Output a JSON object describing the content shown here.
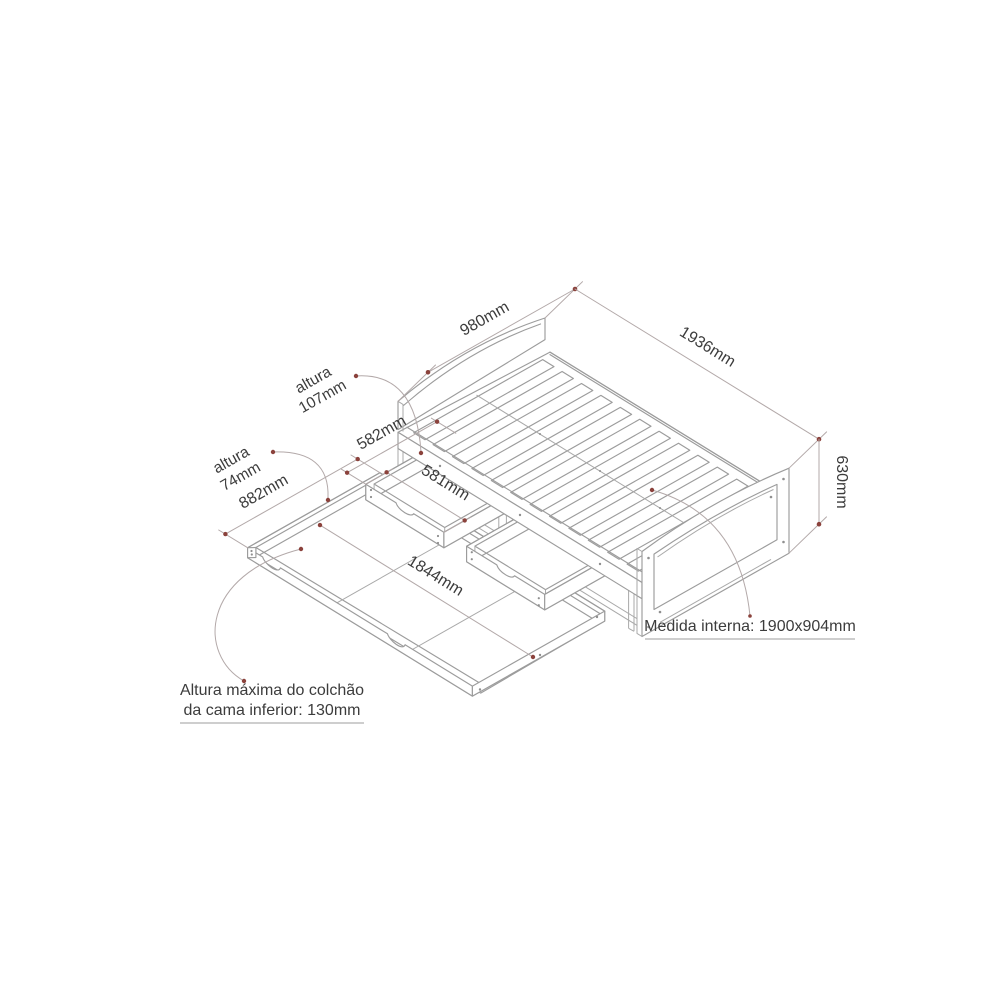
{
  "page": {
    "type": "furniture technical drawing",
    "background": "#ffffff"
  },
  "diagram": {
    "subject": "daybed with two storage drawers and trundle bed, isometric dimensioned view",
    "dimensions": {
      "bed_width": "980mm",
      "bed_length": "1936mm",
      "bed_height": "630mm",
      "drawer_depth": "582mm",
      "drawer_front_width": "581mm",
      "drawer_height_word": "altura",
      "drawer_height": "107mm",
      "trundle_height_word": "altura",
      "trundle_height": "74mm",
      "trundle_width": "882mm",
      "trundle_inner_length": "1844mm"
    },
    "notes": {
      "internal_measure": "Medida interna: 1900x904mm",
      "mattress_note_line1": "Altura máxima do colchão",
      "mattress_note_line2": "da cama inferior: 130mm"
    },
    "colors": {
      "line": "#9c9c9c",
      "dimension_line": "#b3a9a9",
      "marker": "#8b423c",
      "text": "#3c3c3c"
    }
  }
}
